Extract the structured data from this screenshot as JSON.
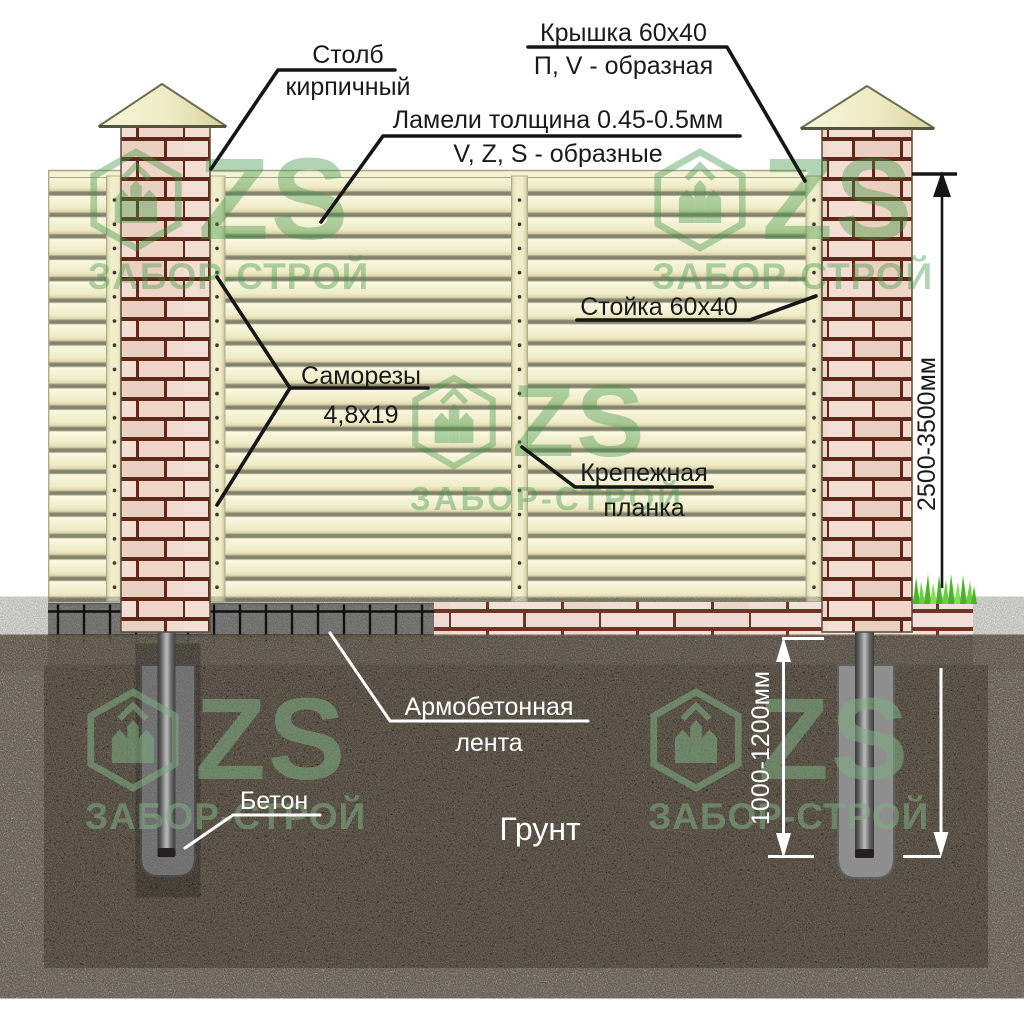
{
  "diagram": {
    "callouts": {
      "stolb": {
        "line1": "Столб",
        "line2": "кирпичный"
      },
      "kryshka": {
        "line1": "Крышка 60x40",
        "line2": "П, V - образная"
      },
      "lameli": {
        "line1": "Ламели толщина 0.45-0.5мм",
        "line2": "V, Z, S - образные"
      },
      "stoyka": {
        "text": "Стойка 60x40"
      },
      "samorezy": {
        "line1": "Саморезы",
        "line2": "4,8x19"
      },
      "krepezh": {
        "line1": "Крепежная",
        "line2": "планка"
      },
      "armo": {
        "line1": "Армобетонная",
        "line2": "лента"
      },
      "beton": {
        "text": "Бетон"
      },
      "grunt": {
        "text": "Грунт"
      }
    },
    "dimensions": {
      "fence_height": "2500-3500мм",
      "foundation_depth": "1000-1200мм"
    },
    "watermark": {
      "logo": "ZS",
      "caption": "ЗАБОР-СТРОЙ"
    },
    "colors": {
      "lamella": "#f5f2d5",
      "lamella_shadow": "#85856a",
      "brick": "#f2dcd2",
      "mortar": "#5e2518",
      "concrete": "#7f7f7f",
      "soil": "#241d15",
      "watermark_green": "#3f9747",
      "grass": "#55cc2e",
      "label": "#1a1a1a",
      "label_on_soil": "#ffffff"
    }
  }
}
